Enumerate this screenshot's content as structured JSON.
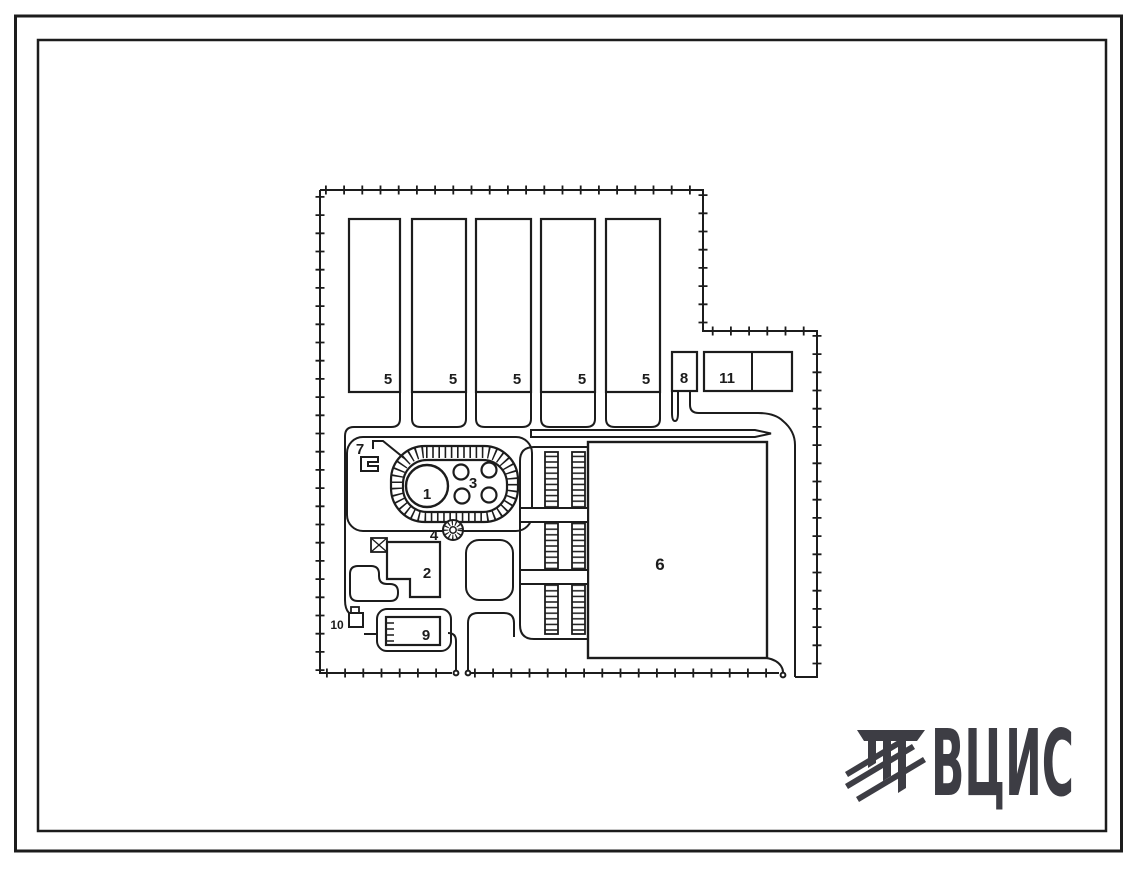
{
  "colors": {
    "ink": "#1c1c1c",
    "logo": "#3d3d44",
    "paper": "#ffffff"
  },
  "site_plan": {
    "labels": {
      "b1": "1",
      "b2": "2",
      "b3": "3",
      "b4": "4",
      "b5": "5",
      "b6": "6",
      "b7": "7",
      "b8": "8",
      "b9": "9",
      "b10": "10",
      "b11": "11"
    }
  },
  "logo": {
    "text": "ВЦИС"
  }
}
